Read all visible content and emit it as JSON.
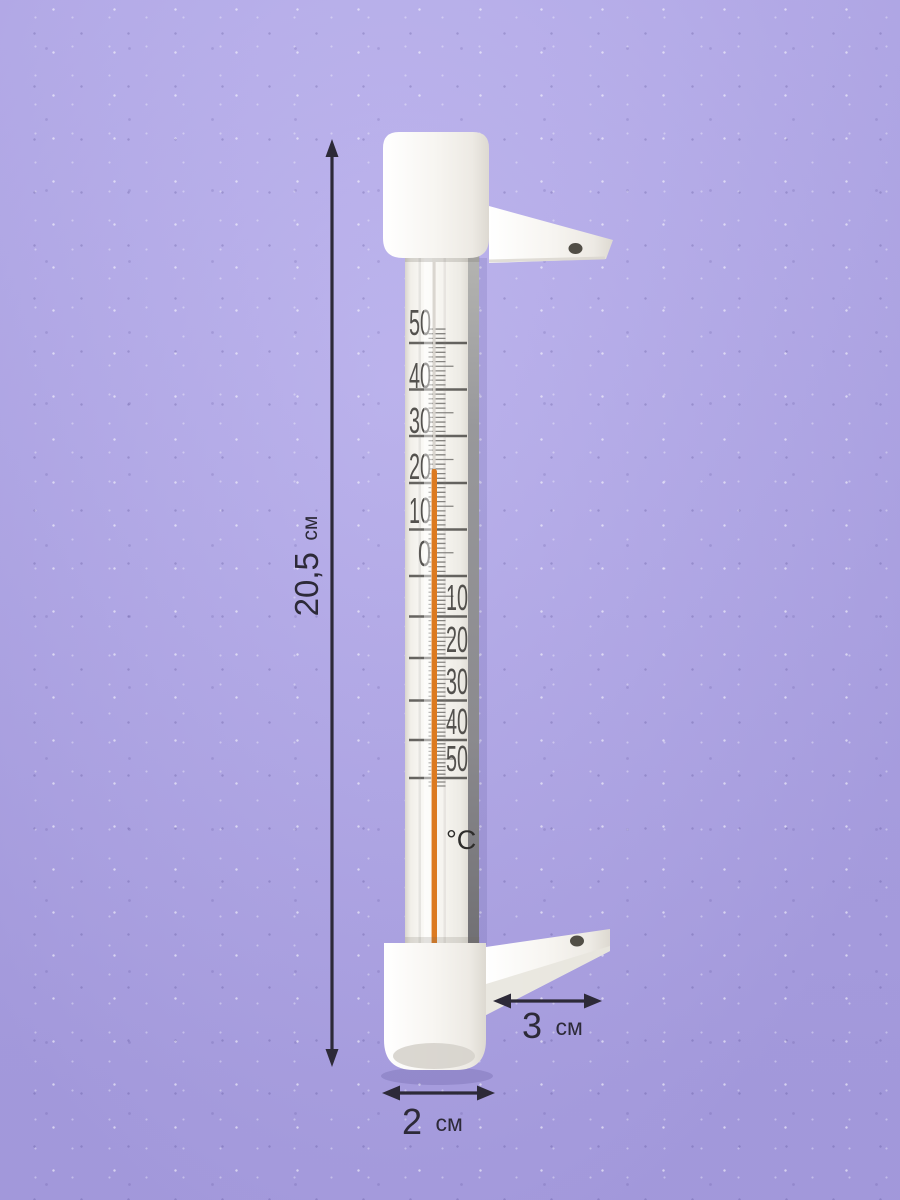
{
  "scene": {
    "background_color": "#b3a9ec",
    "annotation_color": "#2d2a38"
  },
  "thermometer": {
    "body_color": "#f6f4ef",
    "unit_label": "°C",
    "scale": {
      "max_c": 50,
      "min_c": -50,
      "major_step_c": 10,
      "minor_step_c": 1,
      "upper_labels": [
        "50",
        "40",
        "30",
        "20",
        "10",
        "0"
      ],
      "lower_labels": [
        "10",
        "20",
        "30",
        "40",
        "50"
      ],
      "tick_color": "#3e3c39"
    },
    "liquid_column": {
      "color": "#dc7a20",
      "top_value_c": 23
    }
  },
  "annotations": {
    "height": {
      "value": "20,5",
      "unit": "см"
    },
    "bracket_length": {
      "value": "3",
      "unit": "см"
    },
    "diameter": {
      "value": "2",
      "unit": "см"
    }
  }
}
